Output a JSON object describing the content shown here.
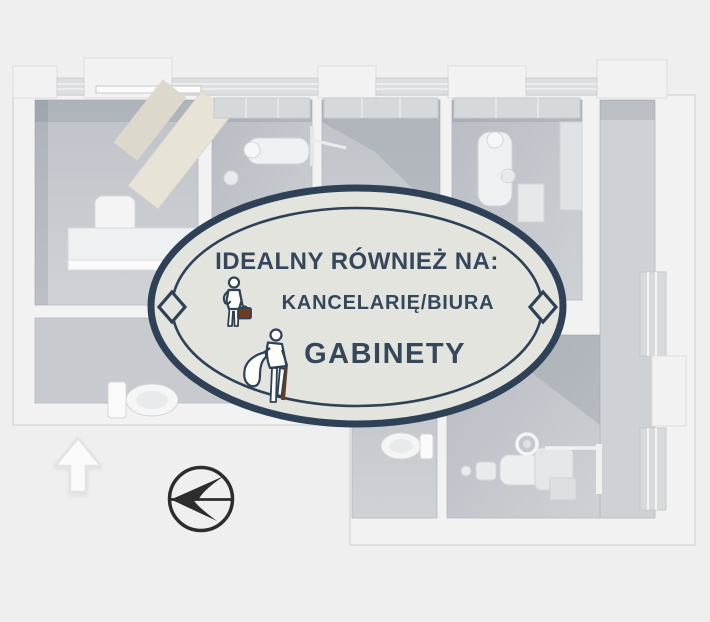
{
  "page": {
    "background_color": "#efefef",
    "scene": "3d-floorplan-render"
  },
  "badge": {
    "heading": "IDEALNY RÓWNIEŻ NA:",
    "items": [
      {
        "label": "KANCELARIĘ/BIURA",
        "icon": "businessman-briefcase-icon"
      },
      {
        "label": "GABINETY",
        "icon": "person-with-coat-cane-icon"
      }
    ],
    "colors": {
      "border_navy": "#2e4156",
      "fill": "#e3e4de",
      "text_navy": "#36475c",
      "briefcase_brown": "#703c1d"
    }
  },
  "markers": {
    "icons": [
      {
        "name": "up-arrow-icon"
      },
      {
        "name": "north-compass-icon"
      }
    ],
    "compass_color": "#2d2d2d"
  }
}
